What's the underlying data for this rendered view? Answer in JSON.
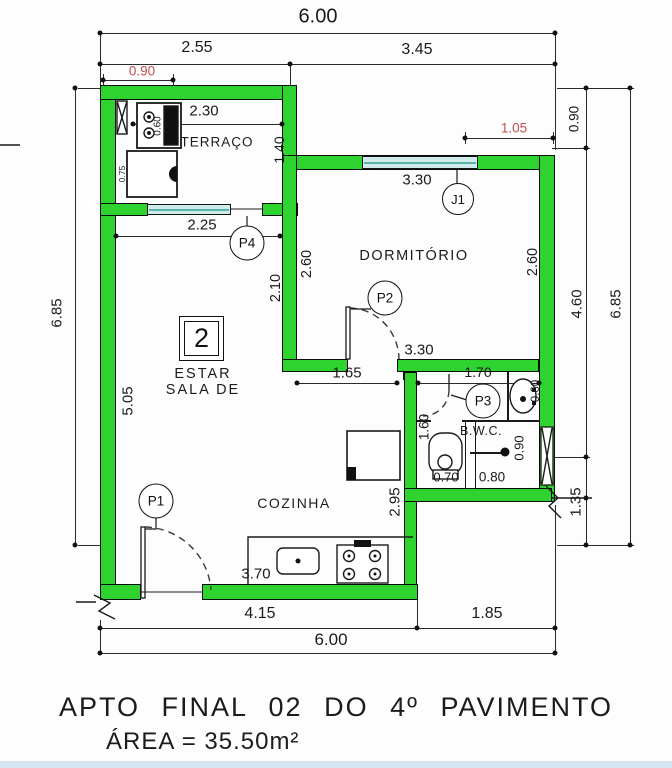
{
  "title": {
    "line1": "APTO FINAL 02 DO 4º PAVIMENTO",
    "line2": "ÁREA = 35.50m²"
  },
  "unit": {
    "number": "2"
  },
  "rooms": {
    "terrace": "TERRAÇO",
    "bedroom": "DORMITÓRIO",
    "living1": "ESTAR",
    "living2": "SALA DE",
    "kitchen": "COZINHA",
    "bathroom": "B.W.C."
  },
  "openings": {
    "p1": "P1",
    "p2": "P2",
    "p3": "P3",
    "p4": "P4",
    "j1": "J1"
  },
  "dims": {
    "top_total": "6.00",
    "top_terrace": "2.55",
    "top_bedroom": "3.45",
    "red_left": "0.90",
    "red_right": "1.05",
    "left_total": "6.85",
    "right_total": "6.85",
    "right_top": "0.90",
    "right_mid": "4.60",
    "right_bottom": "1.35",
    "bottom_kitchen": "4.15",
    "bottom_bwc": "1.85",
    "bottom_total": "6.00",
    "terrace_width": "2.30",
    "terrace_depth": "1.40",
    "terrace_opening": "2.25",
    "bedroom_window": "3.30",
    "bedroom_left": "2.60",
    "bedroom_right": "2.60",
    "bedroom_width": "3.30",
    "living_upper": "2.10",
    "living_height": "5.05",
    "living_opening": "1.65",
    "bwc_width": "1.70",
    "hall_width": "1.60",
    "toilet_width": "0.70",
    "shower_width": "0.80",
    "shower_depth": "0.90",
    "basin_width": "0.60",
    "kitchen_depth": "2.95",
    "counter_length": "3.70",
    "tank_width": "0.60",
    "washer_width": "0.75"
  },
  "colors": {
    "wall_fill": "#2fd32f",
    "wall_outline": "#0b0b0b",
    "window_fill": "#cfecea",
    "window_line": "#5ab4ac",
    "dim_red_text": "#c44f4f",
    "line": "#2a2a2a",
    "footer_strip": "#d7e5f3"
  }
}
